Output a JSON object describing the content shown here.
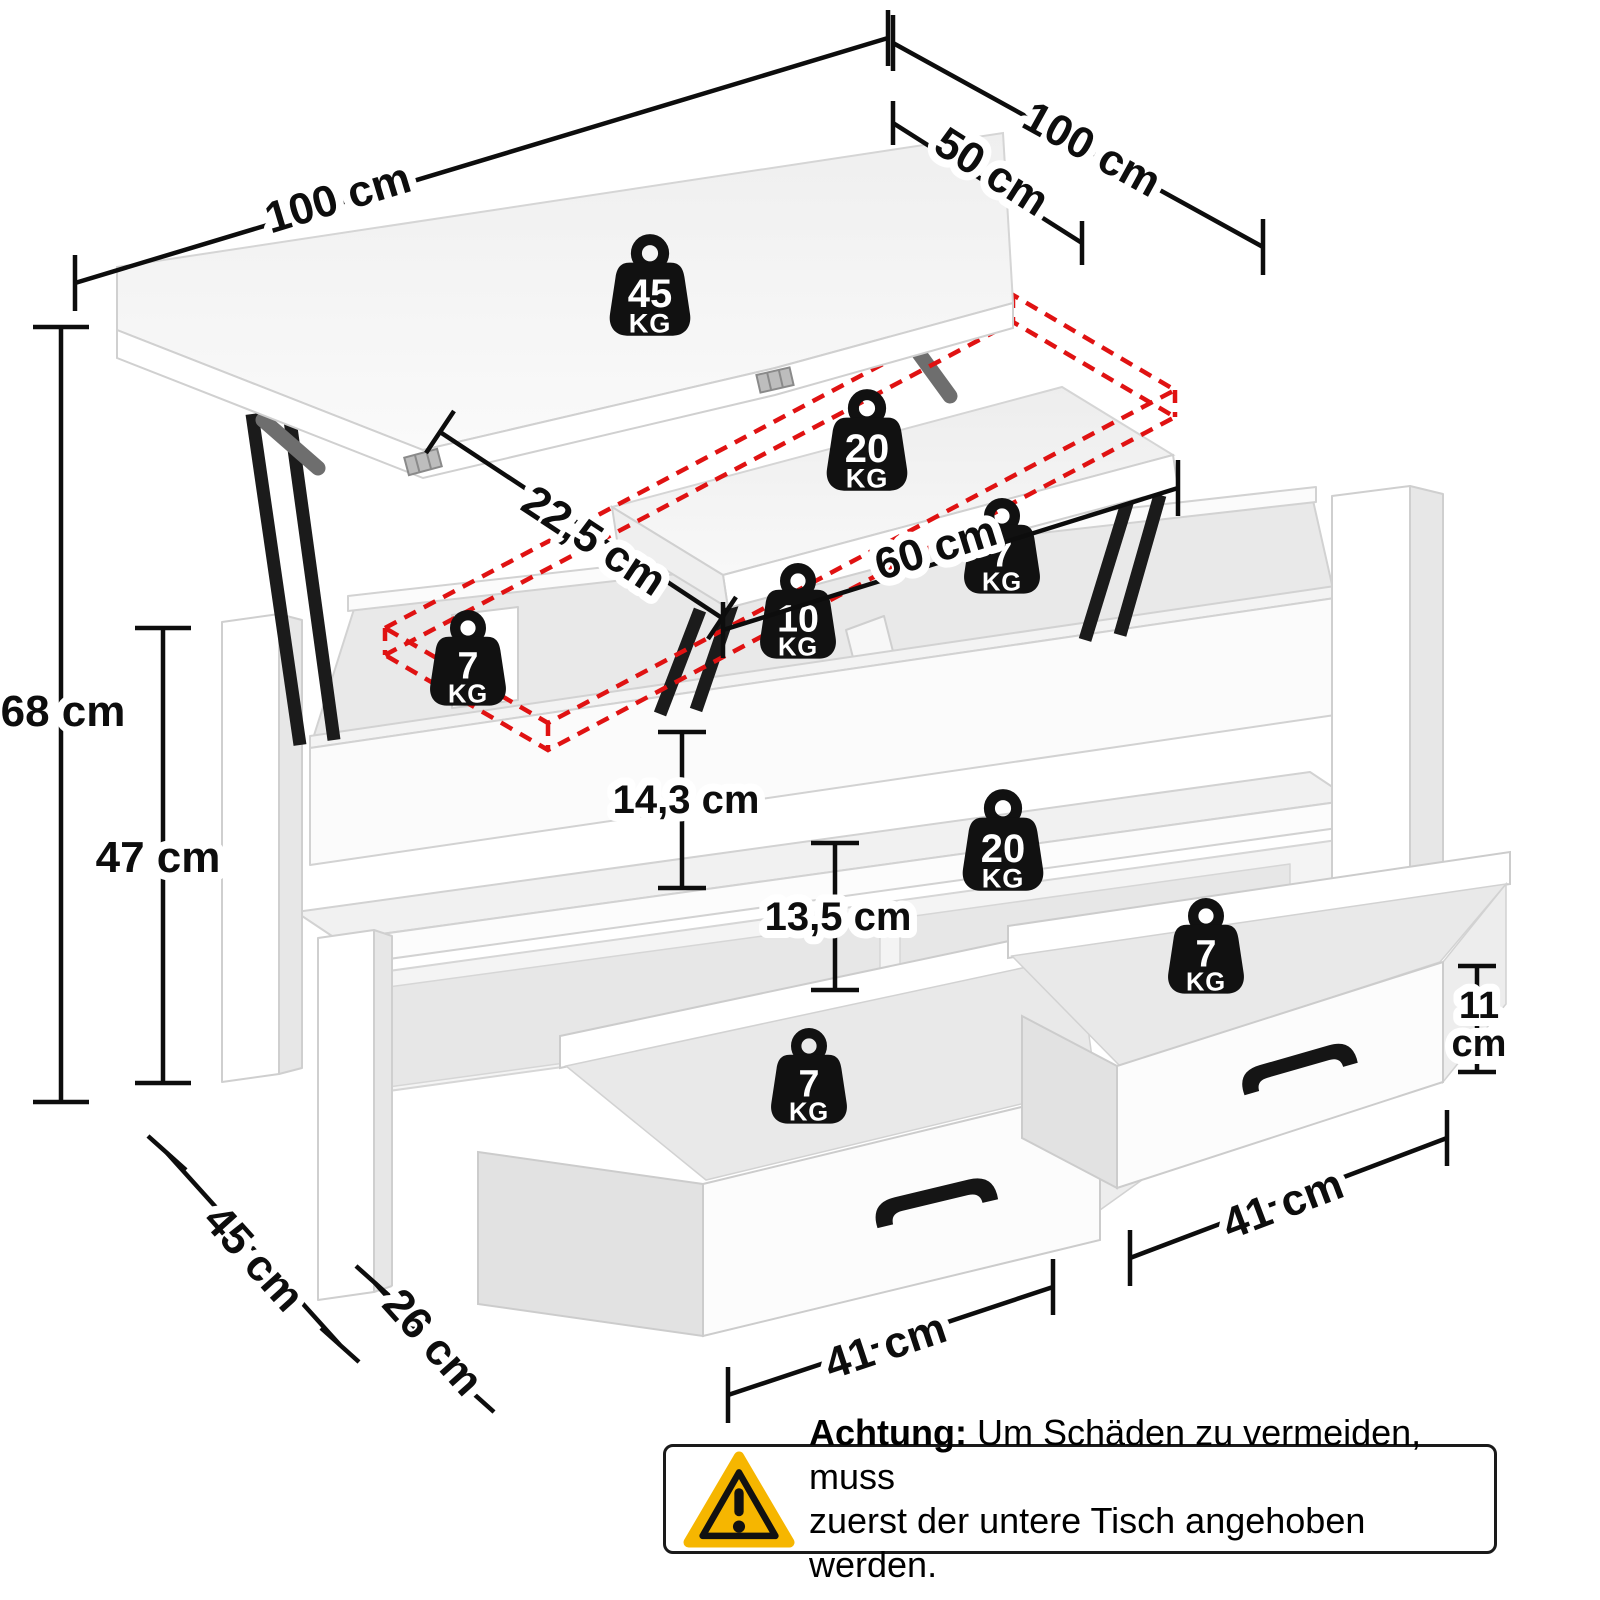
{
  "dimensions": [
    {
      "id": "top-width",
      "label": "100 cm"
    },
    {
      "id": "top-depth-unfolded",
      "label": "100 cm"
    },
    {
      "id": "top-depth-folded",
      "label": "50 cm"
    },
    {
      "id": "height-total",
      "label": "68 cm"
    },
    {
      "id": "height-table",
      "label": "47 cm"
    },
    {
      "id": "lift-clearance",
      "label": "22,5 cm"
    },
    {
      "id": "lift-top-width",
      "label": "60 cm"
    },
    {
      "id": "compartment-depth",
      "label": "14,3 cm"
    },
    {
      "id": "shelf-clearance",
      "label": "13,5 cm"
    },
    {
      "id": "drawer-height",
      "label": "11 cm",
      "line1": "11",
      "line2": "cm"
    },
    {
      "id": "drawer-width-right",
      "label": "41 cm"
    },
    {
      "id": "drawer-width-left",
      "label": "41 cm"
    },
    {
      "id": "base-depth",
      "label": "45 cm"
    },
    {
      "id": "leg-clearance",
      "label": "26 cm"
    }
  ],
  "weights": [
    {
      "id": "tabletop-load",
      "value": "45",
      "unit": "KG"
    },
    {
      "id": "lift-top-load",
      "value": "20",
      "unit": "KG"
    },
    {
      "id": "inner-compartment-right-load",
      "value": "7",
      "unit": "KG"
    },
    {
      "id": "inner-compartment-middle-load",
      "value": "10",
      "unit": "KG"
    },
    {
      "id": "inner-compartment-left-load",
      "value": "7",
      "unit": "KG"
    },
    {
      "id": "shelf-load",
      "value": "20",
      "unit": "KG"
    },
    {
      "id": "drawer-right-load",
      "value": "7",
      "unit": "KG"
    },
    {
      "id": "drawer-left-load",
      "value": "7",
      "unit": "KG"
    }
  ],
  "warning": {
    "label": "Achtung:",
    "line1": "Um Schäden zu vermeiden, muss",
    "line2": "zuerst der untere Tisch angehoben werden."
  },
  "icons": {
    "weight": "kettlebell-weight-icon",
    "warning": "warning-triangle-icon"
  },
  "colors": {
    "accent_red": "#e01212",
    "warning_yellow": "#f6b600",
    "ink": "#0d0d0d"
  }
}
